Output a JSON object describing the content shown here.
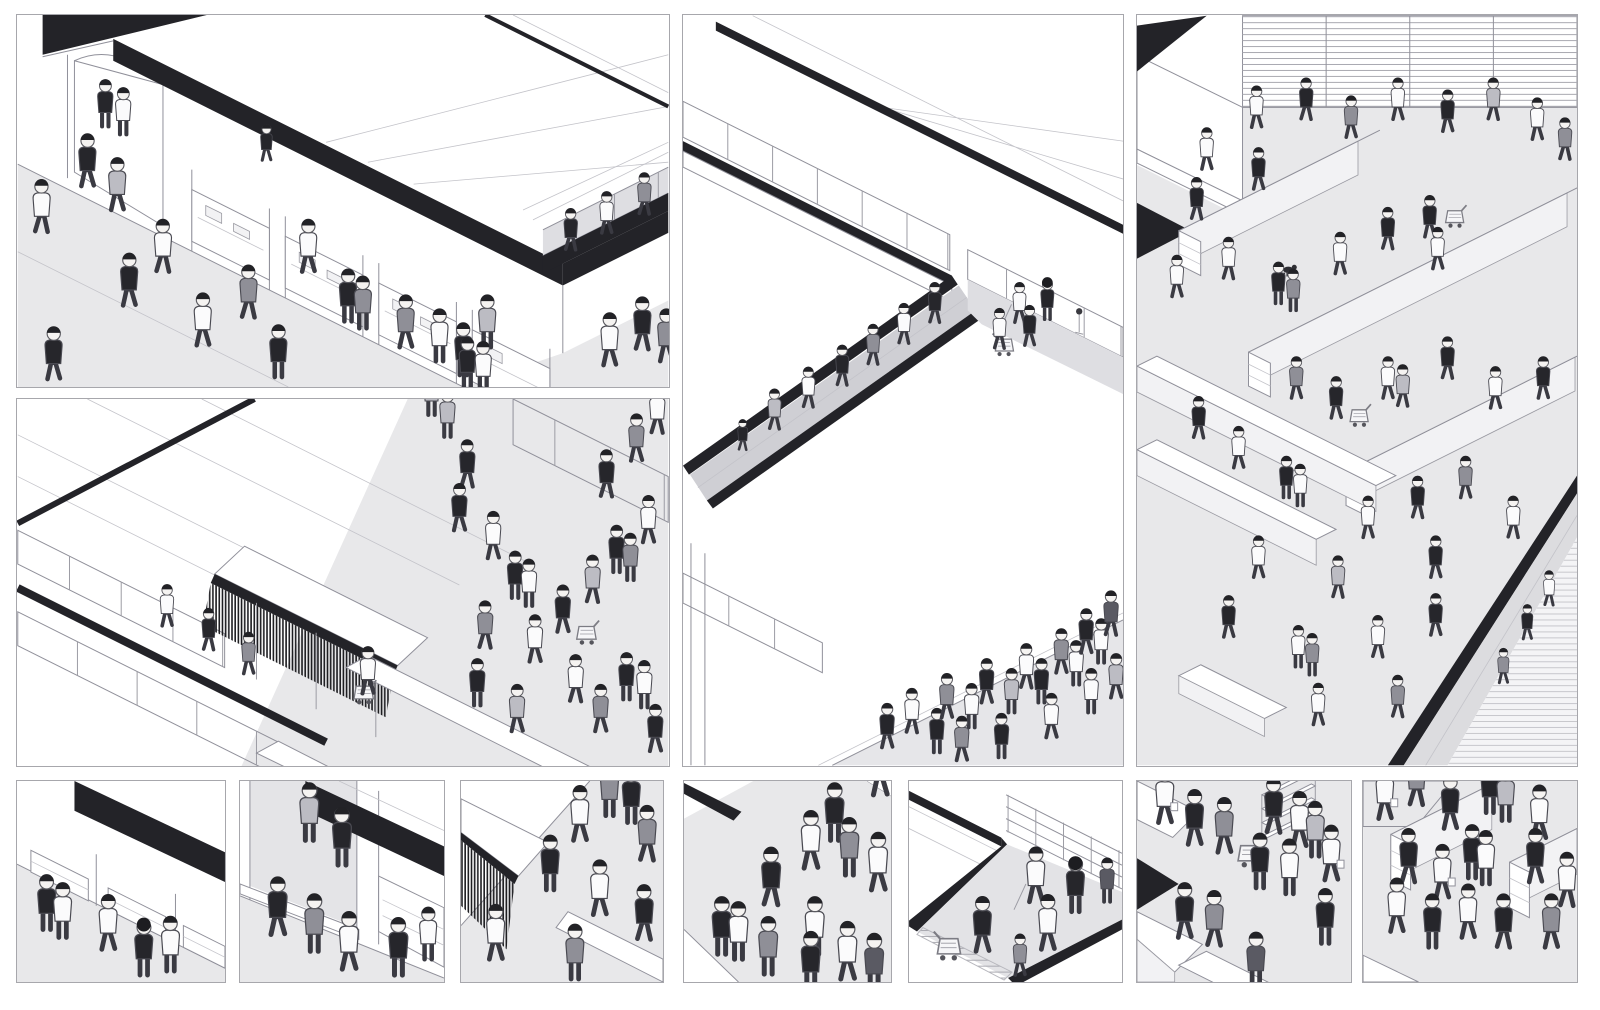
{
  "page": {
    "background": "#ffffff",
    "description": "Black-and-white isometric illustration board of retail scenes: four large panels and seven thumbnail crops, populated with small walking figures, shopping carts and shelving. No text appears in the image."
  },
  "palette": {
    "background": "#ffffff",
    "panel_border": "#a7a7ac",
    "line": "#90909a",
    "thin_line": "#c3c3c9",
    "floor_gray": "#e8e8ea",
    "walkway_gray": "#dedee2",
    "ramp_gray": "#cfcfd4",
    "band_black": "#232328",
    "shelf_side": "#f2f2f4",
    "figure_dark": "#26262b",
    "figure_mid": "#8f8f97",
    "figure_light": "#fbfbfc",
    "skin": "#f5f3f1",
    "hair": "#222226"
  },
  "gallery": {
    "panels": [
      {
        "id": "storefront-street",
        "position": "top-left",
        "figures": 25,
        "description": "Street-level storefront: black diagonal roof band, arched entrance, four display windows, pedestrians on a gray sidewalk and an elevated walkway at right."
      },
      {
        "id": "market-hall",
        "position": "bottom-left",
        "figures": 29,
        "description": "Market hall interior: sloped roof lines, tiered shelf railings with a stair, a canopy stall with dark hanging fringe, long white counters, shoppers and carts on the right."
      },
      {
        "id": "atrium-escalator",
        "position": "center",
        "figures": 28,
        "description": "Mall atrium: zig-zag parapets with black top bands, slatted railings, a long diagonal escalator ramp with descending shoppers, cleaning staff and a cart above, and a crowd on the lower plaza."
      },
      {
        "id": "supermarket-aisles",
        "position": "right",
        "figures": 44,
        "description": "Supermarket floor: louvered back walls, long gondola shelf runs in two directions, low white tables, many shoppers with bags and carts, a dog, and a steep escalator corridor at lower right."
      }
    ],
    "thumbnails": [
      {
        "id": "thumb-storefront-display",
        "figures": 5,
        "description": "Crop of the storefront: black roof band, open display cases and browsing pedestrians."
      },
      {
        "id": "thumb-entrance-walkway",
        "figures": 7,
        "description": "Crop of the entrance: upper walkway figures, black band, and walkers beside a display window."
      },
      {
        "id": "thumb-awning-fringe",
        "figures": 9,
        "description": "Crop of the market stall: dark hanging-fringe awning, white counter and passing shoppers."
      },
      {
        "id": "thumb-plaza-crowd",
        "figures": 13,
        "description": "Crop of the atrium plaza: dense crowd of walking figures on gray floor."
      },
      {
        "id": "thumb-atrium-ramp",
        "figures": 7,
        "description": "Crop of the atrium: chevron parapet, slatted railing, mopping figure, cart on treaded corridor."
      },
      {
        "id": "thumb-checkout-crowd",
        "figures": 13,
        "description": "Crop of the supermarket: shoppers with cart and bags between white tables and a shelf end."
      },
      {
        "id": "thumb-aisle-shoppers",
        "figures": 16,
        "description": "Crop of the supermarket aisles: shelf end-caps, louver wall and many shoppers."
      }
    ]
  }
}
